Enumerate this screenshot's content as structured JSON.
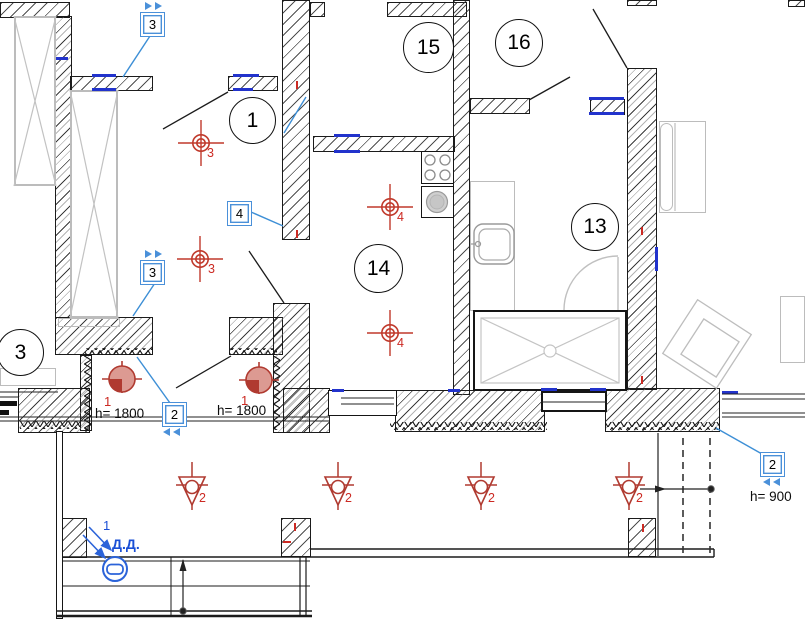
{
  "colors": {
    "symbol_red": "#b03a30",
    "label_red": "#cc2a23",
    "annotation_blue": "#3d8fd6",
    "wall_mark_blue": "#2233cc",
    "detector_blue": "#2b63d9"
  },
  "rooms": [
    {
      "number": "1"
    },
    {
      "number": "3"
    },
    {
      "number": "13"
    },
    {
      "number": "14"
    },
    {
      "number": "15"
    },
    {
      "number": "16"
    }
  ],
  "callouts": [
    {
      "number": "3"
    },
    {
      "number": "4"
    },
    {
      "number": "3"
    },
    {
      "number": "2"
    },
    {
      "number": "2",
      "note": "h= 900"
    }
  ],
  "fixtures": {
    "ceiling_lights": [
      {
        "label": "3"
      },
      {
        "label": "3"
      },
      {
        "label": "4"
      },
      {
        "label": "4"
      }
    ],
    "wall_lights": [
      {
        "label": "1",
        "height": "h= 1800"
      },
      {
        "label": "1",
        "height": "h= 1800"
      }
    ],
    "spot_lights": [
      {
        "label": "2"
      },
      {
        "label": "2"
      },
      {
        "label": "2"
      },
      {
        "label": "2"
      }
    ],
    "door_detector": {
      "label": "1",
      "name": "Д.Д."
    }
  }
}
